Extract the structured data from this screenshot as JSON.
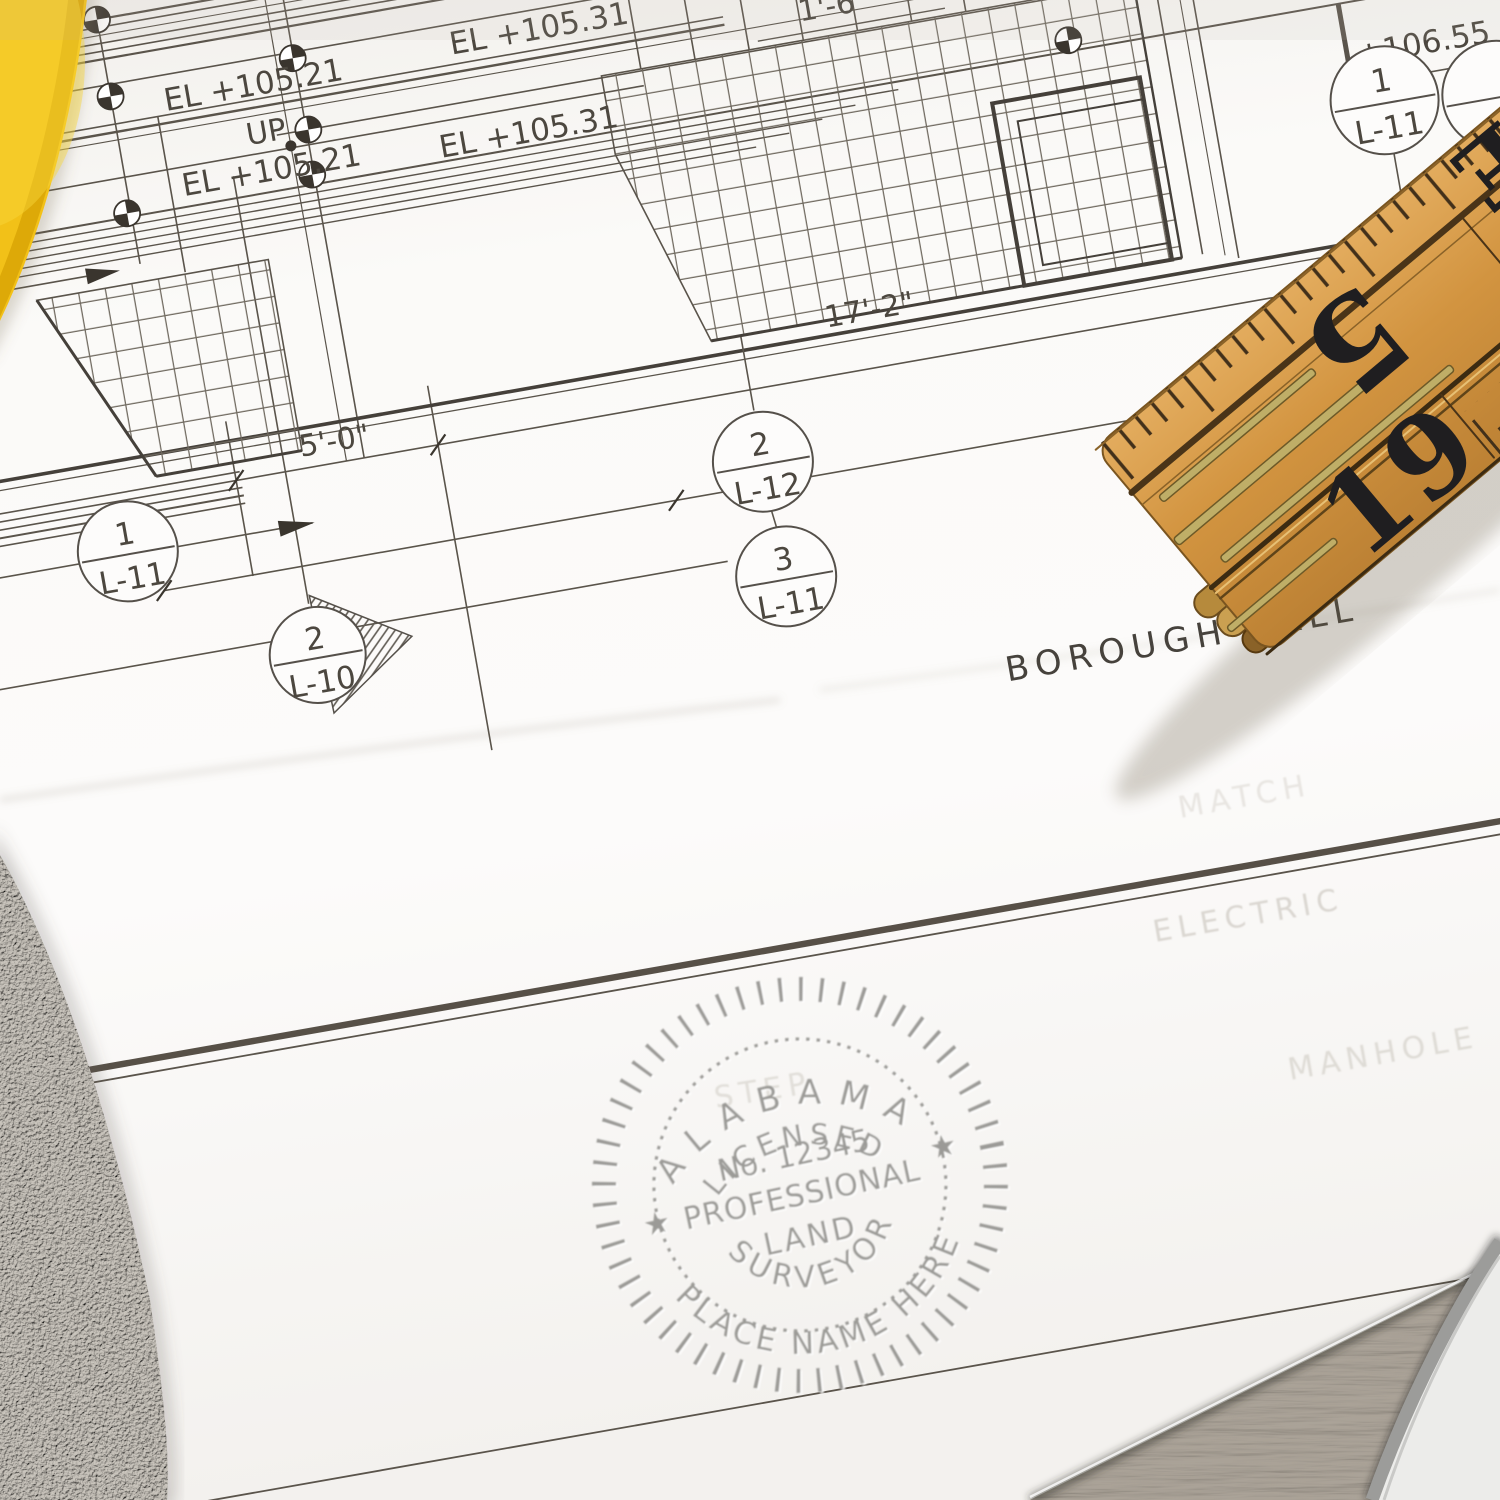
{
  "blueprint": {
    "el_labels": {
      "row1_left": "EL +105.21",
      "row1_right": "EL +105.31",
      "row2_left": "EL +105.21",
      "row2_right": "EL +105.31"
    },
    "up_label": "UP",
    "dims": {
      "d16": "1'-6\"",
      "d172": "17'-2\"",
      "d50": "5'-0\"",
      "elev": "+106.55"
    },
    "callouts": {
      "c1": {
        "num": "1",
        "sheet": "L-11"
      },
      "c2": {
        "num": "2",
        "sheet": "L-12"
      },
      "c3": {
        "num": "3",
        "sheet": "L-11"
      },
      "c4": {
        "num": "1",
        "sheet": "L-11"
      },
      "c5": {
        "num": "2",
        "sheet": "L-10"
      }
    },
    "title": "BOROUGH HALL",
    "ghosts": {
      "g1": "ELECTRIC",
      "g2": "MANHOLE",
      "g3": "STEP",
      "g4": "MATCH"
    }
  },
  "seal": {
    "arc_top": "ALABAMA",
    "licensed": "LICENSED",
    "number": "No. 12345",
    "professional": "PROFESSIONAL",
    "land": "LAND",
    "surveyor": "SURVEYOR",
    "place_name": "PLACE NAME HERE",
    "star_left": "★",
    "star_right": "★",
    "color": "#8f8e8a"
  },
  "ruler": {
    "n5": "5",
    "n19": "19",
    "ne": "E"
  }
}
